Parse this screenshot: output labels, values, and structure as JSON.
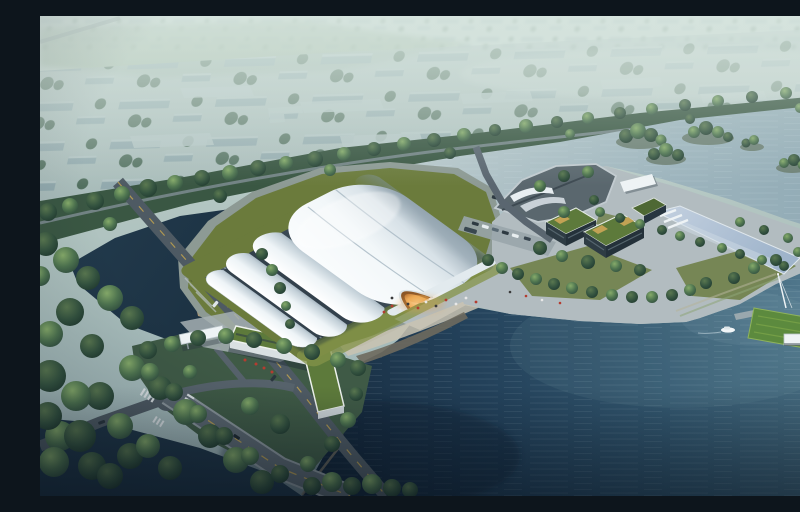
{
  "scene": {
    "type": "architectural-aerial-rendering",
    "title": "Aerial rendering of a lakeside shell-roofed hall campus",
    "description": "Bird's-eye architectural visualization: a large white curved-shell exhibition hall with a warmly lit entrance stands on a lawn plinth beside a broad teal lake; a waterfront promenade leads to green-roofed office blocks, a reflecting pool and a grass pier with a mast, pavilion and moored boat; a tree-lined boulevard, roads, a bridge, parking with cars and a hazy low-rise city fill the background; a river channel with wooded islets crosses the middle.",
    "elements": {
      "main_hall": "white multi-shell exhibition hall",
      "entrance": "arched entrance with warm glow",
      "office_blocks": "dark office blocks with green roofs and yellow roof decks",
      "reflecting_pool": "long reflecting pool with white steps",
      "gatehouse": "L-shaped green-roof gatehouse with white entry canopy",
      "lawn_pier": "grass pier with mast, white pavilion and boat",
      "lake": "large gradient lake",
      "channel": "river channel with tree islets",
      "pond": "dark pond with sand beach",
      "boulevard": "tree-lined boulevard with road",
      "bridge": "road bridge over dark canal",
      "city": "hazy low-rise city blocks with trees",
      "parking": "roadside parking with cars and a bus",
      "promontory": "angular viewpoint promontory with white ramps"
    }
  },
  "colors": {
    "sky_haze": "#b2c5c1",
    "city_block": "#8aa3a8",
    "city_block_light": "#b0c2c2",
    "city_tree": "#3f5f4c",
    "field_green": "#8fa98f",
    "boulevard_band": "#3a5743",
    "channel_water": "#a3b9c0",
    "lake_deep": "#142638",
    "lake_light": "#5d8398",
    "pond_dark": "#1f3547",
    "beach_sand": "#c3a87e",
    "shell_white": "#f6f9fb",
    "shell_seam": "#a9bac4",
    "glass_dark": "#3c4c58",
    "lawn_olive": "#6b7b3c",
    "lawn_bright": "#84944a",
    "plinth_gray": "#8d9a94",
    "plaza_light": "#b2bcc0",
    "step_tan": "#c9c3b2",
    "boardwalk": "#6e6a5e",
    "road_gray": "#4e5a63",
    "bridge_gray": "#5b6770",
    "road_line_yellow": "#c8a74e",
    "roof_green": "#5d7a3b",
    "roof_yellow": "#c2a254",
    "block_dark": "#2e3c44",
    "pool_blue": "#a9bccf",
    "pier_green": "#5c8a3e",
    "glow_orange": "#e8a34c",
    "people_red": "#b43c30",
    "white": "#eef3f5",
    "promontory_dark": "#5a676e",
    "grass_dark": "#3f5a46"
  }
}
